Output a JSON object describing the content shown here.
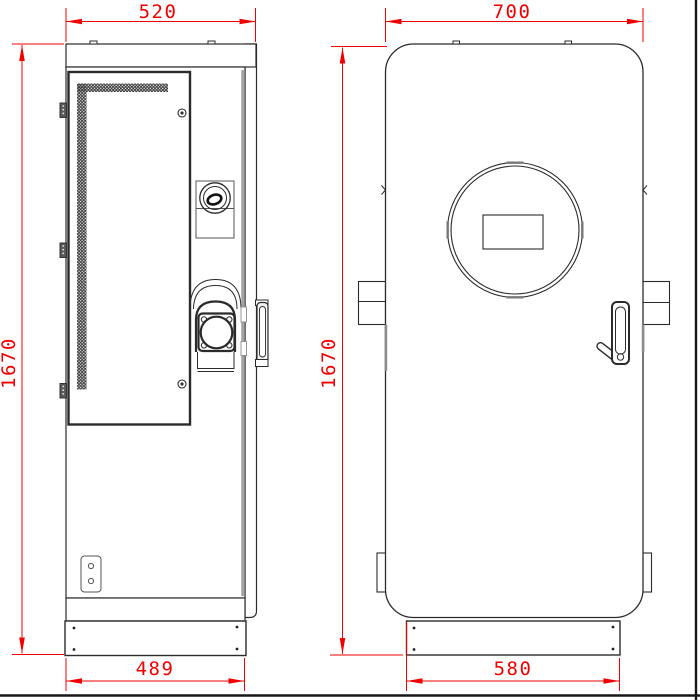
{
  "drawing": {
    "type": "technical-orthographic-drawing",
    "dimensions": {
      "side_view": {
        "top_width": "520",
        "height": "1670",
        "base_width": "489"
      },
      "front_view": {
        "top_width": "700",
        "height": "1670",
        "base_width": "580"
      }
    },
    "colors": {
      "dimension_red": "#f20000",
      "line_dark": "#2b2b2b",
      "line_gray": "#a3a3a3",
      "sheet_border_black": "#161616"
    },
    "parts": {
      "side_view": [
        "ventilated-service-door",
        "door-hinges",
        "cam-lock",
        "charging-socket",
        "handle-side-profile",
        "latch-slots",
        "cable-gland-plate",
        "base-plate"
      ],
      "front_view": [
        "circular-display-bezel",
        "display-window",
        "front-door-handle",
        "mounting-brackets",
        "bottom-feet",
        "base-plate"
      ]
    }
  }
}
